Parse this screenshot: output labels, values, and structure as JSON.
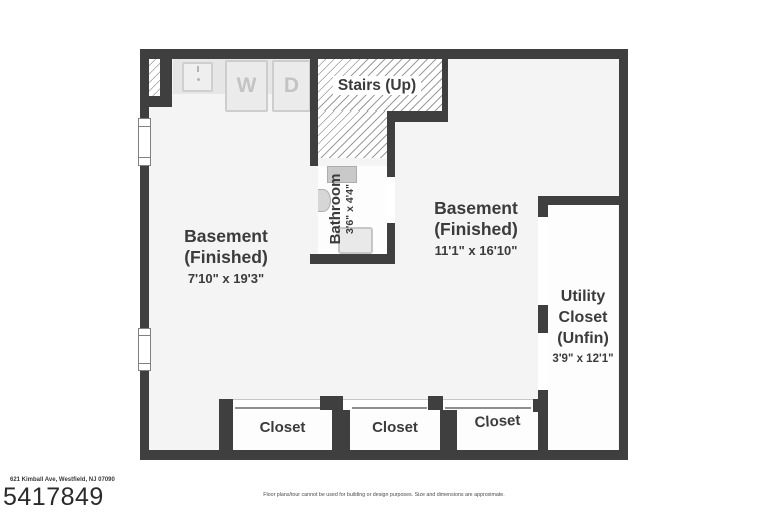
{
  "floorplan": {
    "stairs": {
      "label": "Stairs (Up)"
    },
    "laundry": {
      "washer": "W",
      "dryer": "D"
    },
    "bathroom": {
      "name": "Bathroom",
      "dims": "3'6\" x 4'4\""
    },
    "basement_left": {
      "name": "Basement",
      "status": "(Finished)",
      "dims": "7'10\" x 19'3\""
    },
    "basement_right": {
      "name": "Basement",
      "status": "(Finished)",
      "dims": "11'1\" x 16'10\""
    },
    "utility_closet": {
      "line1": "Utility",
      "line2": "Closet",
      "line3": "(Unfin)",
      "dims": "3'9\" x 12'1\""
    },
    "closets": [
      "Closet",
      "Closet",
      "Closet"
    ]
  },
  "footer": {
    "address": "621 Kimball Ave, Westfield, NJ 07090",
    "listing_number": "5417849",
    "disclaimer": "Floor plans/tour cannot be used for building or design purposes. Size and dimensions are approximate."
  },
  "colors": {
    "wall": "#3f3f3f",
    "floor": "#f4f4f4",
    "room_white": "#fdfdfd",
    "counter": "#e6e6e6",
    "appliance": "#ebebeb",
    "appliance_border": "#cdcdcd",
    "hatch_line": "#9b9b9b",
    "text": "#3b3b3b"
  }
}
